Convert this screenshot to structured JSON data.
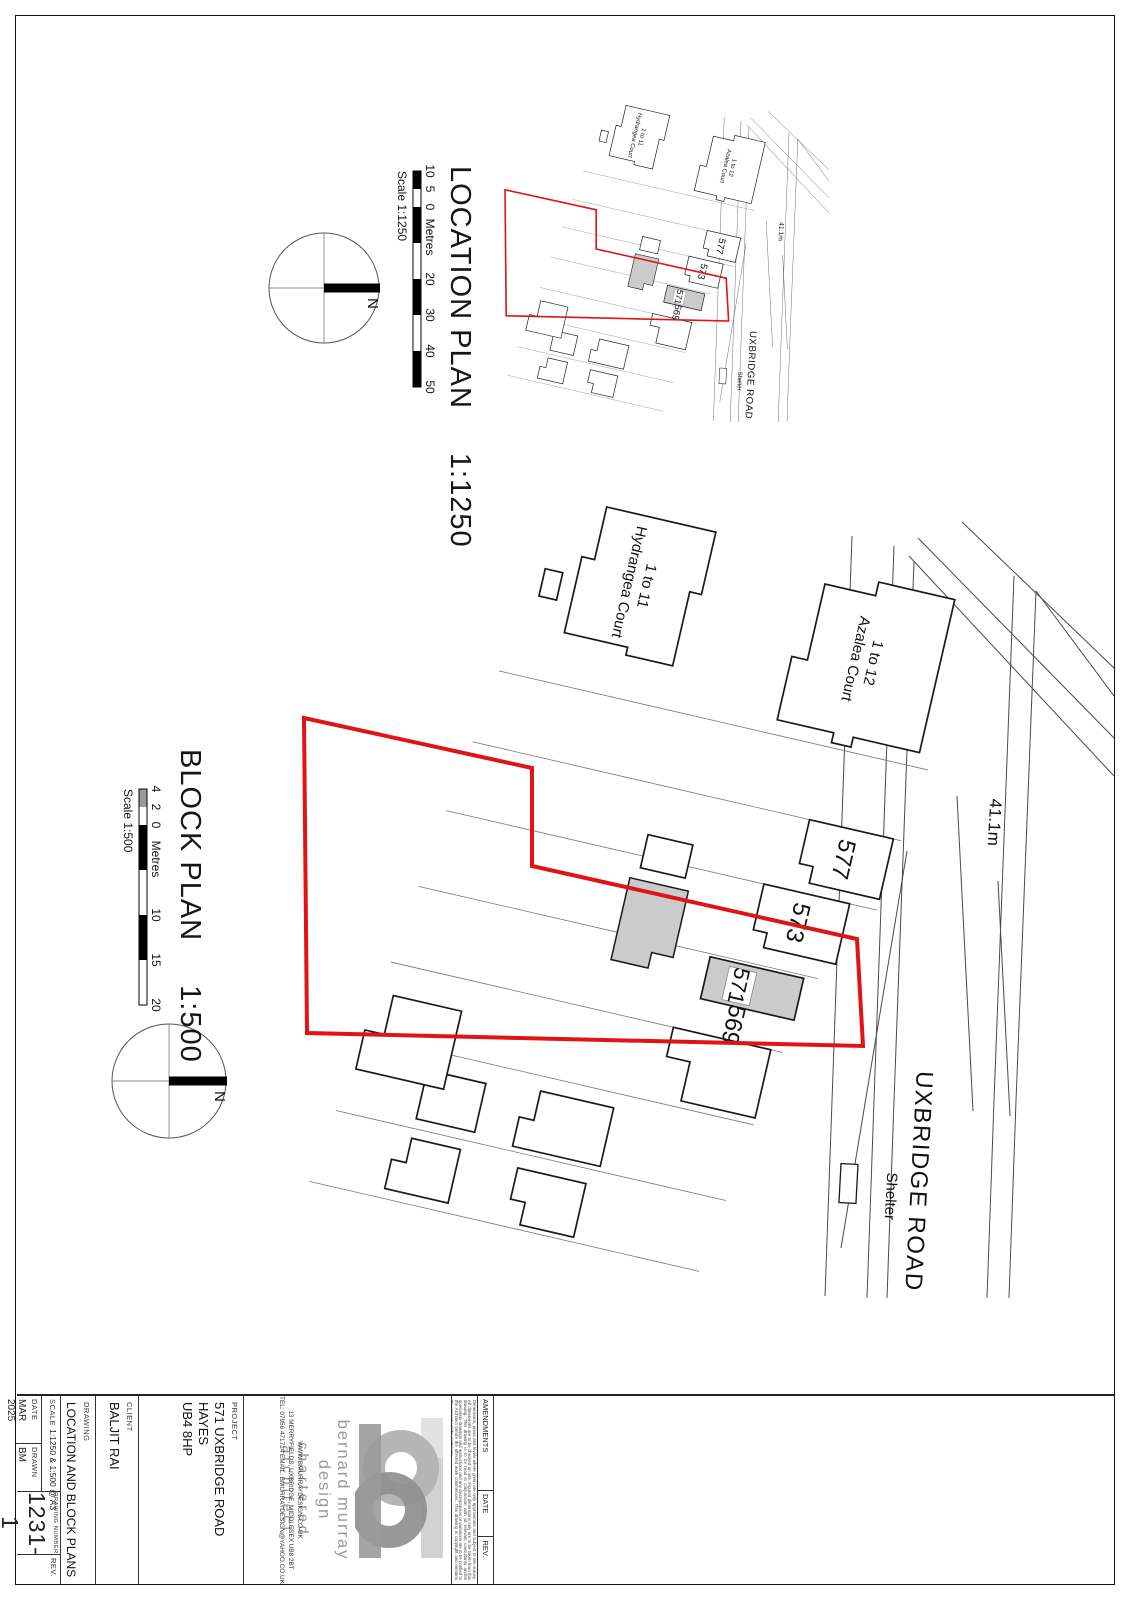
{
  "sheet": {
    "location_plan": {
      "title": "LOCATION PLAN",
      "scale": "1:1250",
      "scale_caption": "Scale 1:1250",
      "scalebar_labels": [
        "10",
        "5",
        "0",
        "Metres",
        "20",
        "30",
        "40",
        "50"
      ],
      "north_label": "N"
    },
    "block_plan": {
      "title": "BLOCK PLAN",
      "scale": "1:500",
      "scale_caption": "Scale 1:500",
      "scalebar_labels": [
        "4",
        "2",
        "0",
        "Metres",
        "10",
        "15",
        "20"
      ],
      "north_label": "N"
    },
    "map": {
      "road_name": "UXBRIDGE ROAD",
      "road_width": "41.1m",
      "shelter": "Shelter",
      "house_571": "571",
      "house_569": "569",
      "house_573": "573",
      "house_577": "577",
      "azalea_line1": "1 to 12",
      "azalea_line2": "Azalea Court",
      "hydrangea_line1": "1 to 11",
      "hydrangea_line2": "Hydrangea Court"
    },
    "title_block": {
      "amendments_header": "AMENDMENTS",
      "date_header": "DATE",
      "rev_header": "REV.",
      "disclaimer": "Dimensions, areas and levels where given are only approximate and subject to site survey. All dimensions are to be checked on site. Figured dimensions only are to be taken from this drawing. This drawing is to be read in conjunction with all relevant consultants and/or specialists drawings and instructions and any discrepancies or variations are to be notified to the Architect before the affected work commences. This drawing is copyright and remains the property of the Architects.",
      "brand_line1": "bernard murray design",
      "brand_line2": "chartered architect",
      "website": "WWW.BMURRAYDESIGN.CO.UK",
      "address": "13 MERRYFIELDS, UXBRIDGE, MIDDLESEX UB8 2BT",
      "tel_email": "TEL: 07956 471714    EMAIL: BMURRAYDESIGN@YAHOO.CO.UK",
      "project_label": "PROJECT",
      "project_line1": "571 UXBRIDGE ROAD",
      "project_line2": "HAYES",
      "project_line3": "UB4 8HP",
      "client_label": "CLIENT",
      "client_name": "BALJIT RAI",
      "drawing_label": "DRAWING",
      "drawing_title": "LOCATION AND BLOCK PLANS",
      "scale_label": "SCALE",
      "scale_value": "1:1250 & 1:500 @ A3",
      "date_label": "DATE",
      "date_value": "MAR 2025",
      "drawn_label": "DRAWN",
      "drawn_value": "BM",
      "number_label": "DRAWING NUMBER",
      "number_value": "1231-1",
      "rev_label": "REV."
    },
    "colors": {
      "site_boundary_red": "#e01414",
      "building_fill_gray": "#cbcbcb",
      "line_gray": "#4a4a4a"
    }
  }
}
